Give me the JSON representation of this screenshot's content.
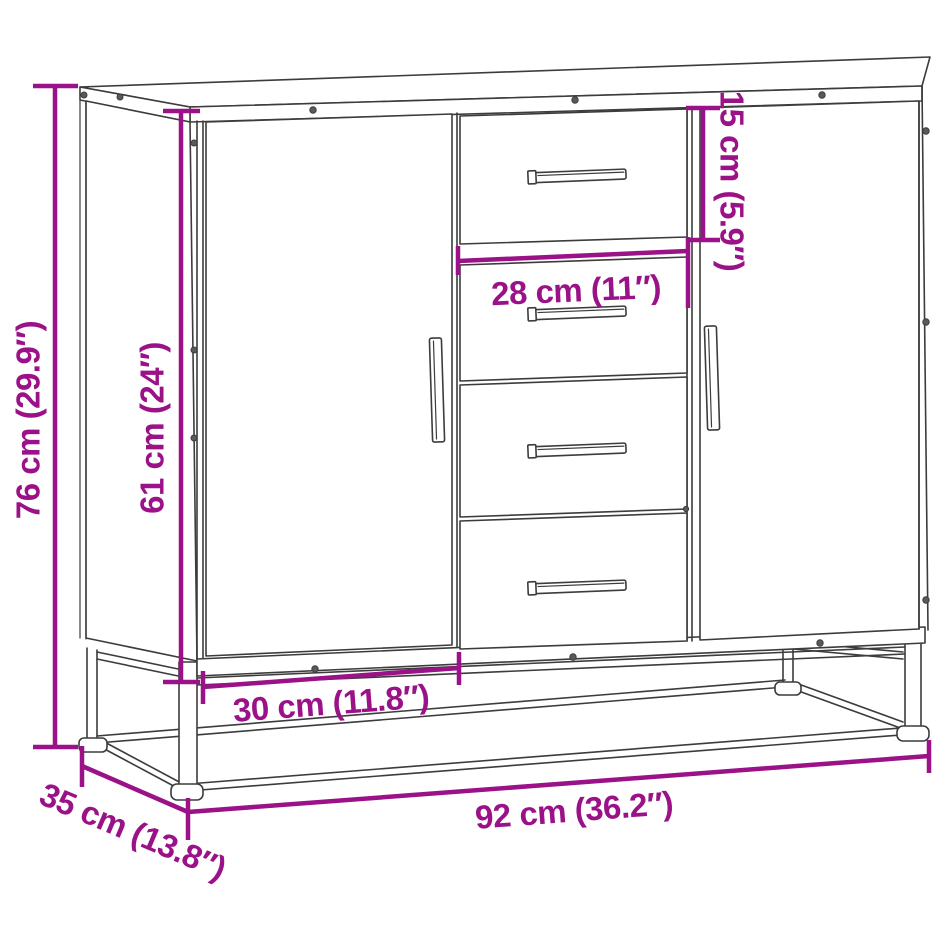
{
  "page": {
    "width_px": "947",
    "height_px": "947",
    "background": "#ffffff"
  },
  "diagram": {
    "kind": "product-dimension-line-drawing",
    "depicted_object": "sideboard with two doors, four drawers and metal base frame",
    "accent_color": "#9A1188",
    "line_color": "#3C3C3C",
    "dimensions": {
      "overall_height": {
        "label": "76 cm (29.9″)",
        "cm": "76",
        "inches": "29.9"
      },
      "body_height": {
        "label": "61 cm (24″)",
        "cm": "61",
        "inches": "24"
      },
      "top_drawer_height": {
        "label": "15 cm (5.9″)",
        "cm": "15",
        "inches": "5.9"
      },
      "drawer_width": {
        "label": "28 cm (11″)",
        "cm": "28",
        "inches": "11"
      },
      "door_width": {
        "label": "30 cm (11.8″)",
        "cm": "30",
        "inches": "11.8"
      },
      "overall_width": {
        "label": "92 cm (36.2″)",
        "cm": "92",
        "inches": "36.2"
      },
      "depth": {
        "label": "35 cm (13.8″)",
        "cm": "35",
        "inches": "13.8"
      }
    }
  }
}
